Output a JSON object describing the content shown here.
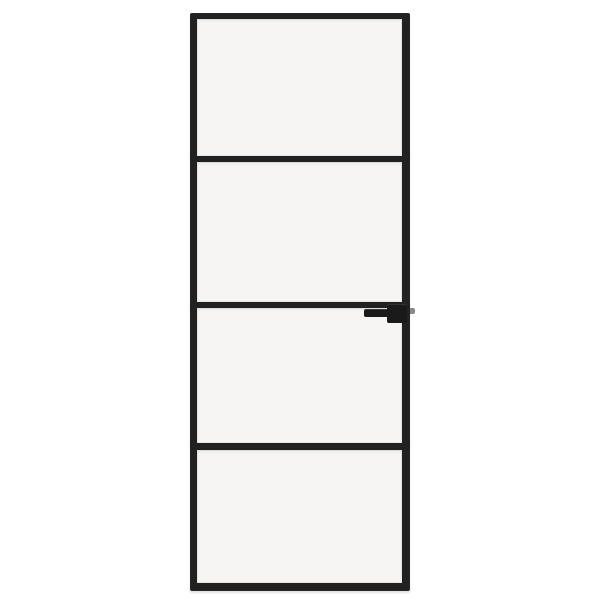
{
  "scene": {
    "type": "product-photo",
    "object": "interior-glass-door",
    "description": "Tall narrow interior glass door with a slim black aluminium frame, four frosted-white glass panes separated by three horizontal black bars, and a black lever handle with a grey latch pin on the right stile, photographed on a plain white background.",
    "text_content": ""
  },
  "colors": {
    "background": "#ffffff",
    "frame": "#212121",
    "glass": "#f6f5f3",
    "handle": "#1a1a1a",
    "latch-pin": "#8a8a8a"
  },
  "door": {
    "pane_count": 4,
    "muntin_bar_count": 3,
    "handle_side": "right",
    "handle_row": "below middle bar (third pane)",
    "panes": [
      "pane-1",
      "pane-2",
      "pane-3",
      "pane-4"
    ]
  }
}
